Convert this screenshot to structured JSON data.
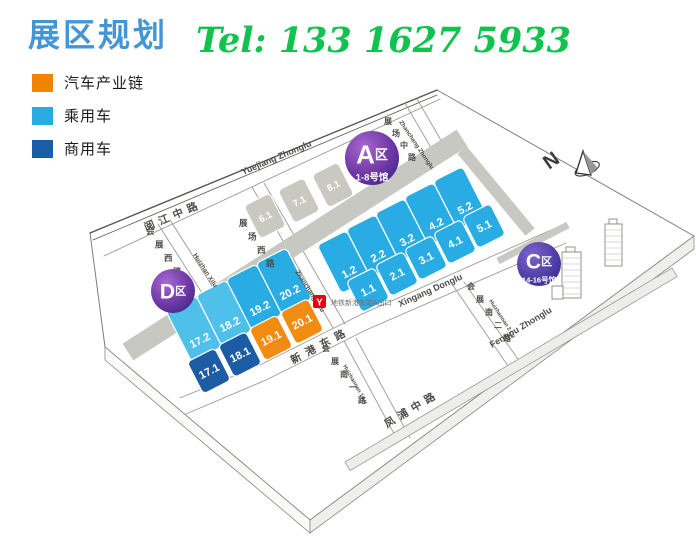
{
  "header": {
    "title": "展区规划",
    "phone": "Tel: 133 1627 5933"
  },
  "legend": {
    "items": [
      {
        "label": "汽车产业链",
        "color": "#F08300"
      },
      {
        "label": "乘用车",
        "color": "#29ABE2"
      },
      {
        "label": "商用车",
        "color": "#1B5CA6"
      }
    ]
  },
  "colors": {
    "title_blue": "#4495D6",
    "phone_green": "#12C24E",
    "passenger": "#29ACE3",
    "passenger_light": "#4FC0EA",
    "commercial": "#1C5CA5",
    "industry": "#F28B12",
    "hall_other": "#C9C8C1",
    "badge_purple": "#5B2D8F",
    "metro_red": "#E60012"
  },
  "map": {
    "badges": [
      {
        "id": "A",
        "zone": "A",
        "suffix": "区",
        "sub": "1-8号馆"
      },
      {
        "id": "D",
        "zone": "D",
        "suffix": "区",
        "sub": ""
      },
      {
        "id": "C",
        "zone": "C",
        "suffix": "区",
        "sub": "14-16号馆"
      }
    ],
    "hall_rows": [
      {
        "row": "A-back",
        "ids": [
          "6.1",
          "7.1",
          "8.1"
        ]
      },
      {
        "row": "A-upper",
        "ids": [
          "1.2",
          "2.2",
          "3.2",
          "4.2",
          "5.2"
        ]
      },
      {
        "row": "A-lower",
        "ids": [
          "1.1",
          "2.1",
          "3.1",
          "4.1",
          "5.1"
        ]
      },
      {
        "row": "D-upper",
        "ids": [
          "17.2",
          "18.2",
          "19.2",
          "20.2"
        ]
      },
      {
        "row": "D-lower",
        "ids": [
          "17.1",
          "18.1",
          "19.1",
          "20.1"
        ]
      }
    ],
    "roads": [
      {
        "id": "yuejiang",
        "cn": "阅江中路",
        "en": "Yuejiang Zhonglu"
      },
      {
        "id": "xingang",
        "cn": "新港东路",
        "en": "Xingang Donglu"
      },
      {
        "id": "fengpu",
        "cn": "凤浦中路",
        "en": "Fengpu Zhonglu"
      },
      {
        "id": "zhanchang_zhonglu",
        "cn": "展场中路",
        "en": "Zhanchang Zhonglu"
      },
      {
        "id": "zhanchang_xilu",
        "cn": "展场西路",
        "en": "Zhanchang Xilu"
      },
      {
        "id": "huizhan_xilu",
        "cn": "会展西路",
        "en": "Huizhan Xilu"
      },
      {
        "id": "huizhannan2",
        "cn": "会展南二路",
        "en": "Huizhannan 2 Lu"
      },
      {
        "id": "huizhannan1",
        "cn": "会展南一路",
        "en": "Huizhannan 1 Lu"
      }
    ],
    "metro": {
      "label": "地铁新港东站A出口",
      "logo": "Y"
    },
    "compass": {
      "label": "N"
    }
  }
}
